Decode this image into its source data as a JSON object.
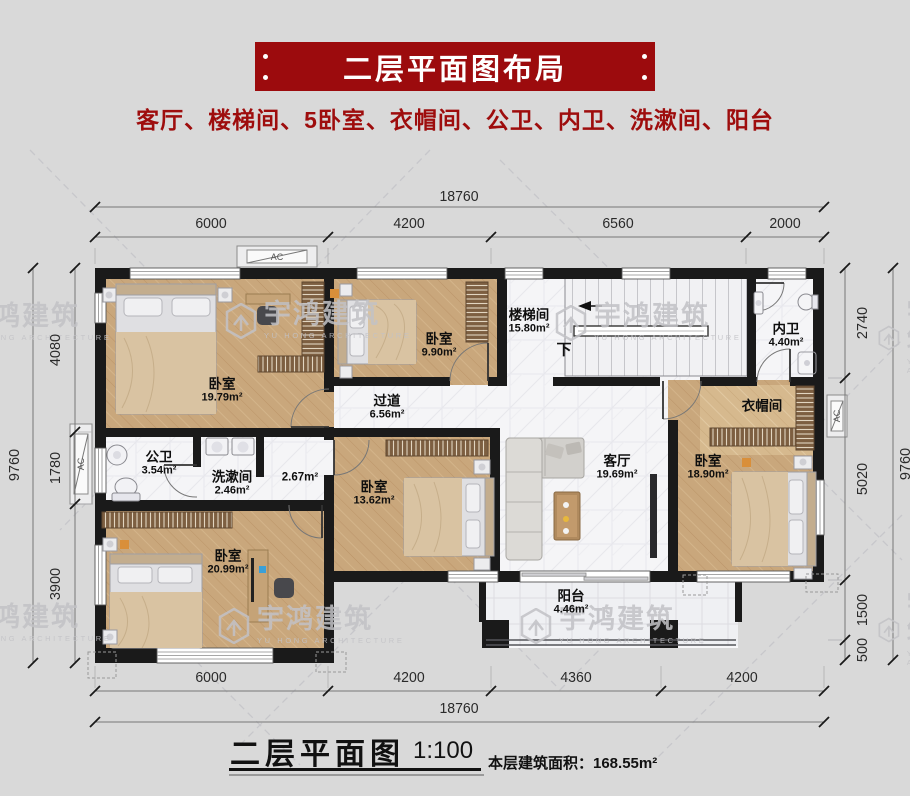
{
  "header": {
    "banner_title": "二层平面图布局",
    "subtitle": "客厅、楼梯间、5卧室、衣帽间、公卫、内卫、洗漱间、阳台"
  },
  "plan": {
    "rooms": {
      "bedroom_top_left": {
        "name": "卧室",
        "area": "19.79m²"
      },
      "bedroom_top_mid": {
        "name": "卧室",
        "area": "9.90m²"
      },
      "stairwell": {
        "name": "楼梯间",
        "area": "15.80m²",
        "down": "下"
      },
      "bath_private": {
        "name": "内卫",
        "area": "4.40m²"
      },
      "hallway": {
        "name": "过道",
        "area": "6.56m²"
      },
      "bath_public": {
        "name": "公卫",
        "area": "3.54m²"
      },
      "washroom": {
        "name": "洗漱间",
        "area": "2.46m²"
      },
      "corridor": {
        "area": "2.67m²"
      },
      "bedroom_mid": {
        "name": "卧室",
        "area": "13.62m²"
      },
      "living_room": {
        "name": "客厅",
        "area": "19.69m²"
      },
      "cloakroom": {
        "name": "衣帽间"
      },
      "bedroom_right": {
        "name": "卧室",
        "area": "18.90m²"
      },
      "bedroom_bottom_left": {
        "name": "卧室",
        "area": "20.99m²"
      },
      "balcony": {
        "name": "阳台",
        "area": "4.46m²"
      }
    },
    "ac_label": "AC"
  },
  "dimensions": {
    "top": {
      "total": "18760",
      "segments": [
        "6000",
        "4200",
        "6560",
        "2000"
      ]
    },
    "bottom": {
      "total": "18760",
      "segments": [
        "6000",
        "4200",
        "4360",
        "4200"
      ]
    },
    "left": {
      "total": "9760",
      "segments": [
        "4080",
        "1780",
        "3900"
      ]
    },
    "right": {
      "total": "9760",
      "segments": [
        "2740",
        "5020",
        "1500",
        "500"
      ]
    }
  },
  "watermark": {
    "brand": "宇鸿建筑",
    "brand_sub": "YU HONG ARCHITECTURE"
  },
  "footer": {
    "title": "二层平面图",
    "scale": "1:100",
    "area_note": "本层建筑面积：168.55m²"
  },
  "colors": {
    "banner_red": "#9c0b0d",
    "wall_black": "#1a1a1a",
    "wood_floor": "#c9a77c"
  }
}
